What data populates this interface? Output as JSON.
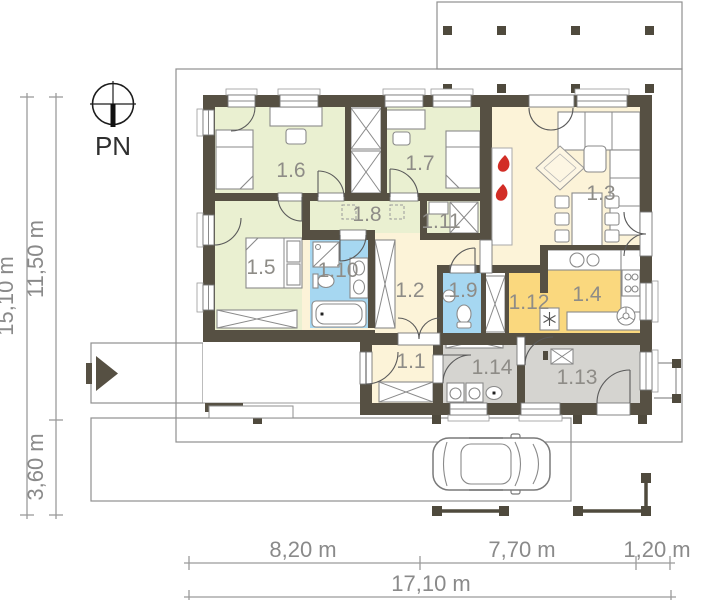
{
  "plan": {
    "compass_label": "PN",
    "rooms": [
      {
        "id": "1.1",
        "label": "1.1"
      },
      {
        "id": "1.2",
        "label": "1.2"
      },
      {
        "id": "1.3",
        "label": "1.3"
      },
      {
        "id": "1.4",
        "label": "1.4"
      },
      {
        "id": "1.5",
        "label": "1.5"
      },
      {
        "id": "1.6",
        "label": "1.6"
      },
      {
        "id": "1.7",
        "label": "1.7"
      },
      {
        "id": "1.8",
        "label": "1.8"
      },
      {
        "id": "1.9",
        "label": "1.9"
      },
      {
        "id": "1.10",
        "label": "1.10"
      },
      {
        "id": "1.11",
        "label": "1.11"
      },
      {
        "id": "1.12",
        "label": "1.12"
      },
      {
        "id": "1.13",
        "label": "1.13"
      },
      {
        "id": "1.14",
        "label": "1.14"
      }
    ],
    "dimensions": {
      "vertical_total": "15,10 m",
      "vertical_house": "11,50 m",
      "vertical_drive": "3,60 m",
      "bottom_left": "8,20 m",
      "bottom_mid": "7,70 m",
      "bottom_right": "1,20 m",
      "bottom_total": "17,10 m"
    },
    "colors": {
      "wall": "#565043",
      "room_green": "#EAF0D1",
      "room_cream": "#FCF3D8",
      "room_blue": "#A6D7F1",
      "room_yellow": "#FAD87E",
      "room_gray": "#D5D4D0",
      "flame_red": "#D22D26"
    }
  }
}
